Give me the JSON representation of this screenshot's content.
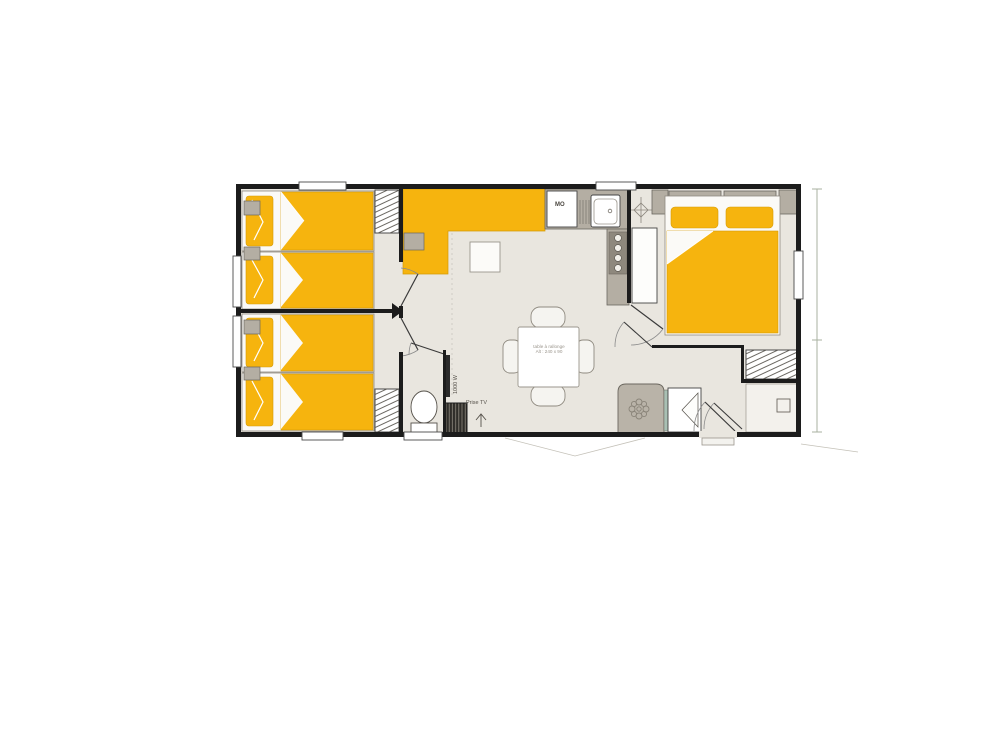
{
  "page": {
    "type": "mobile-home floor plan drawing",
    "background": "#ffffff"
  },
  "plan": {
    "labels": {
      "microwave": "MO",
      "radiator_power": "1000 W",
      "tv_socket": "Prise TV",
      "table_line1": "table à rallonge",
      "table_line2": "Alt : 240 x 90"
    },
    "colors": {
      "wall": "#1c1c1c",
      "floor": "#e9e6df",
      "highlight_yellow": "#f6b40e",
      "furniture_gray": "#b4aea3",
      "outline_gray": "#6b675f",
      "dimension_line": "#a8b2a0"
    },
    "icons": [
      "ceiling-light-icon",
      "fan-icon",
      "antenna-icon",
      "burner-icon",
      "drain-icon"
    ],
    "rooms": [
      "bedroom-twin-1",
      "bedroom-twin-2",
      "living-dining-room",
      "kitchen",
      "wc",
      "bathroom",
      "master-bedroom",
      "shower-room"
    ]
  }
}
